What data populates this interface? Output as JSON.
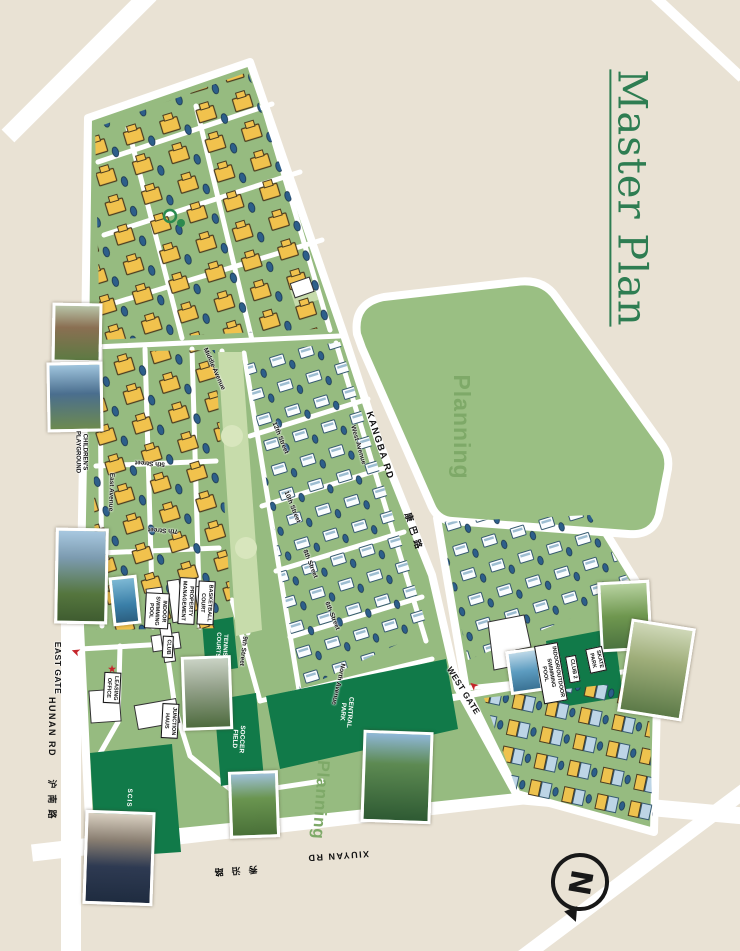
{
  "page": {
    "title": "Master Plan",
    "compass_letter": "N"
  },
  "roads": {
    "kangba_en": "KANGBA RD",
    "kangba_zh": "康巴路",
    "hunan_en": "HUNAN RD",
    "hunan_zh": "沪南路",
    "xiuyan_en": "XIUYAN RD",
    "xiuyan_zh": "秀沿路"
  },
  "gates": {
    "east": "EAST GATE",
    "west": "WEST GATE"
  },
  "avenues": {
    "east": "East Avenue",
    "middle": "Middle Avenue",
    "west": "West Avenue",
    "north": "North Avenue"
  },
  "streets": {
    "s5": "5th Street",
    "s6": "6th Street",
    "s7": "7th Street",
    "s8": "8th Street",
    "s9": "9th Street",
    "s10": "10th Street",
    "s12": "12th Street"
  },
  "areas": {
    "planning": "Planning",
    "central_park": "CENTRAL\nPARK",
    "soccer_field": "SOCCER\nFIELD",
    "tennis_courts": "TENNIS\nCOURTS",
    "scis": "SCIS",
    "childrens_playground": "CHILDREN'S\nPLAYGROUND",
    "skate_park": "SKATE\nPARK"
  },
  "facilities": {
    "property_management": "PROPERTY\nMANAGEMENT",
    "indoor_swimming_pool": "INDOOR\nSWIMMING\nPOOL",
    "basketball_court": "BASKETBALL\nCOURT",
    "club": "CLUB",
    "leasing_office": "LEASING\nOFFICE",
    "junction_haus": "JUNCTION\nHAUS",
    "club2": "CLUB 2",
    "indoor_outdoor_pool": "INDOOR/OUTDOOR\nSWIMMING\nPOOL"
  },
  "icons": {
    "gate_arrow": "➤",
    "leasing_star": "★"
  },
  "colors": {
    "background": "#e9e2d4",
    "site_green": "#96bb80",
    "planning_green": "#9abf83",
    "facility_dark_green": "#117a49",
    "park_light_green": "#c7dcab",
    "road_white": "#ffffff",
    "villa_yellow": "#f1c24d",
    "townhome_blue": "#bdd5e6",
    "car_blue": "#2d5f8a",
    "accent_red": "#c5252b",
    "title_green": "#2e7d52",
    "planning_text": "#7ea968"
  }
}
